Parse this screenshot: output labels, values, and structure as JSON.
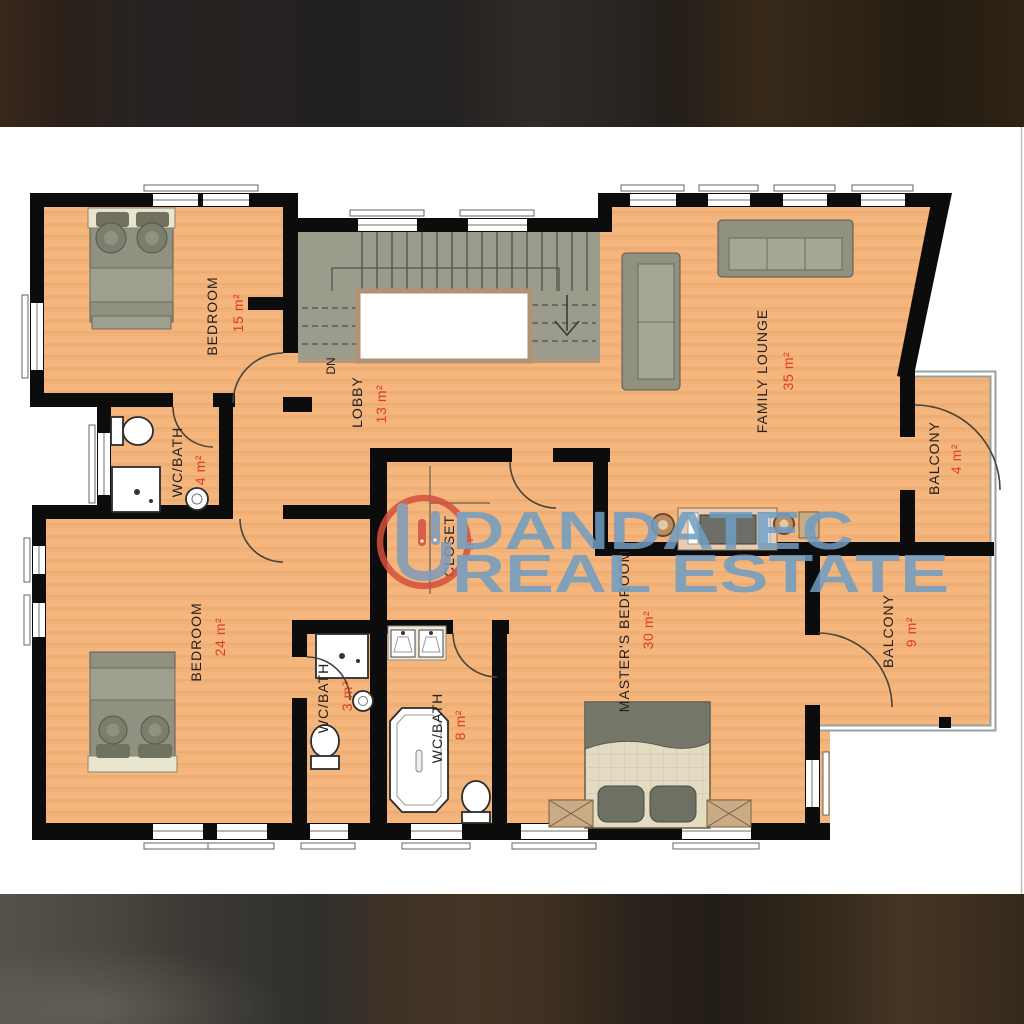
{
  "watermark": {
    "brand_line1": "DANDATEC",
    "brand_line2": "REAL ESTATE"
  },
  "stairs": {
    "down_label": "DN"
  },
  "rooms": {
    "bedroom_top": {
      "name": "BEDROOM",
      "area": "15 m²"
    },
    "wc_bath_top": {
      "name": "WC/BATH",
      "area": "4 m²"
    },
    "lobby": {
      "name": "LOBBY",
      "area": "13 m²"
    },
    "family_lounge": {
      "name": "FAMILY LOUNGE",
      "area": "35 m²"
    },
    "balcony_upper": {
      "name": "BALCONY",
      "area": "4 m²"
    },
    "bedroom_bottom": {
      "name": "BEDROOM",
      "area": "24 m²"
    },
    "wc_bath_middle": {
      "name": "WC/BATH",
      "area": "3 m²"
    },
    "closet": {
      "name": "CLOSET",
      "area": "7 m²"
    },
    "wc_bath_master": {
      "name": "WC/BATH",
      "area": "8 m²"
    },
    "master_bedroom": {
      "name": "MASTER'S BEDROOM",
      "area": "30 m²"
    },
    "balcony_lower": {
      "name": "BALCONY",
      "area": "9 m²"
    }
  },
  "colors": {
    "floor": "#f5b67e",
    "walls": "#0c0c0c",
    "area_text": "#e03b22",
    "room_text": "#212121",
    "stairs": "#9b9c8b",
    "watermark_blue": "#6f9dc3",
    "watermark_ring": "#d4503e"
  }
}
